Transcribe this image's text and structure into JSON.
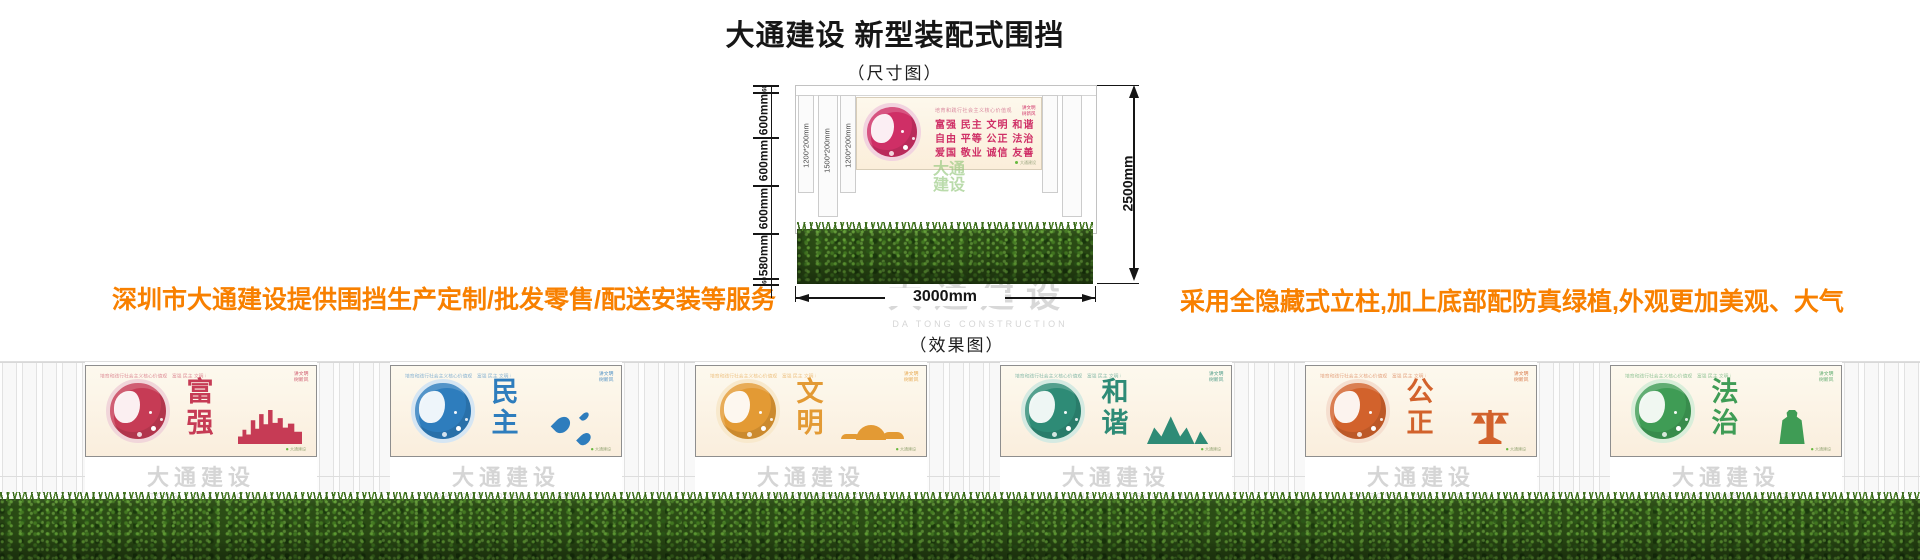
{
  "header": {
    "title": "大通建设 新型装配式围挡",
    "subtitle": "（尺寸图）"
  },
  "brand": {
    "cn": "大通建设",
    "en": "DA TONG CONSTRUCTION"
  },
  "notes": {
    "left": "深圳市大通建设提供围挡生产定制/批发零售/配送安装等服务",
    "right": "采用全隐藏式立柱,加上底部配防真绿植,外观更加美观、大气"
  },
  "colors": {
    "accent": "#f88000",
    "dimension_line": "#151515",
    "watermark_gray": "#cbcbcb",
    "grass_dark": "#2b4c15"
  },
  "dimension_diagram": {
    "left_segments": [
      {
        "label": "60"
      },
      {
        "label": "600mm"
      },
      {
        "label": "600mm"
      },
      {
        "label": "600mm"
      },
      {
        "label": "580mm"
      },
      {
        "label": "60"
      }
    ],
    "height_label": "2500mm",
    "width_label": "3000mm",
    "post_labels": [
      "1200*200mm",
      "1500*200mm",
      "1200*200mm"
    ],
    "poster": {
      "color": "#cf2f66",
      "light": "#f2d3df",
      "slogan": "培育和践行社会主义核心价值观",
      "rows": [
        "富强  民主  文明  和谐",
        "自由  平等  公正  法治",
        "爱国  敬业  诚信  友善"
      ],
      "corner": "讲文明 树新风",
      "footer_note": "大通建设",
      "brand_lines": [
        "大通",
        "建设"
      ]
    }
  },
  "effect": {
    "label": "（效果图）",
    "strip": "培育和践行社会主义核心价值观　富强 民主 文明 和谐 自由 平等 公正 法治 爱国 敬业 诚信 友善",
    "corner": "讲文明 树新风",
    "footer_note": "大通建设",
    "panels": [
      {
        "word": "富强",
        "motif": "skyline",
        "color": "#c63b55",
        "light": "#f1d6da"
      },
      {
        "word": "民主",
        "motif": "drops",
        "color": "#2e7dbd",
        "light": "#d6e6f3"
      },
      {
        "word": "文明",
        "motif": "clouds",
        "color": "#e39a34",
        "light": "#f8e9cd"
      },
      {
        "word": "和谐",
        "motif": "mountains",
        "color": "#2e8b76",
        "light": "#d5eae2"
      },
      {
        "word": "公正",
        "motif": "scale",
        "color": "#d2622c",
        "light": "#f5dfd0"
      },
      {
        "word": "法治",
        "motif": "figure",
        "color": "#3f9c55",
        "light": "#d9eeda"
      }
    ]
  }
}
